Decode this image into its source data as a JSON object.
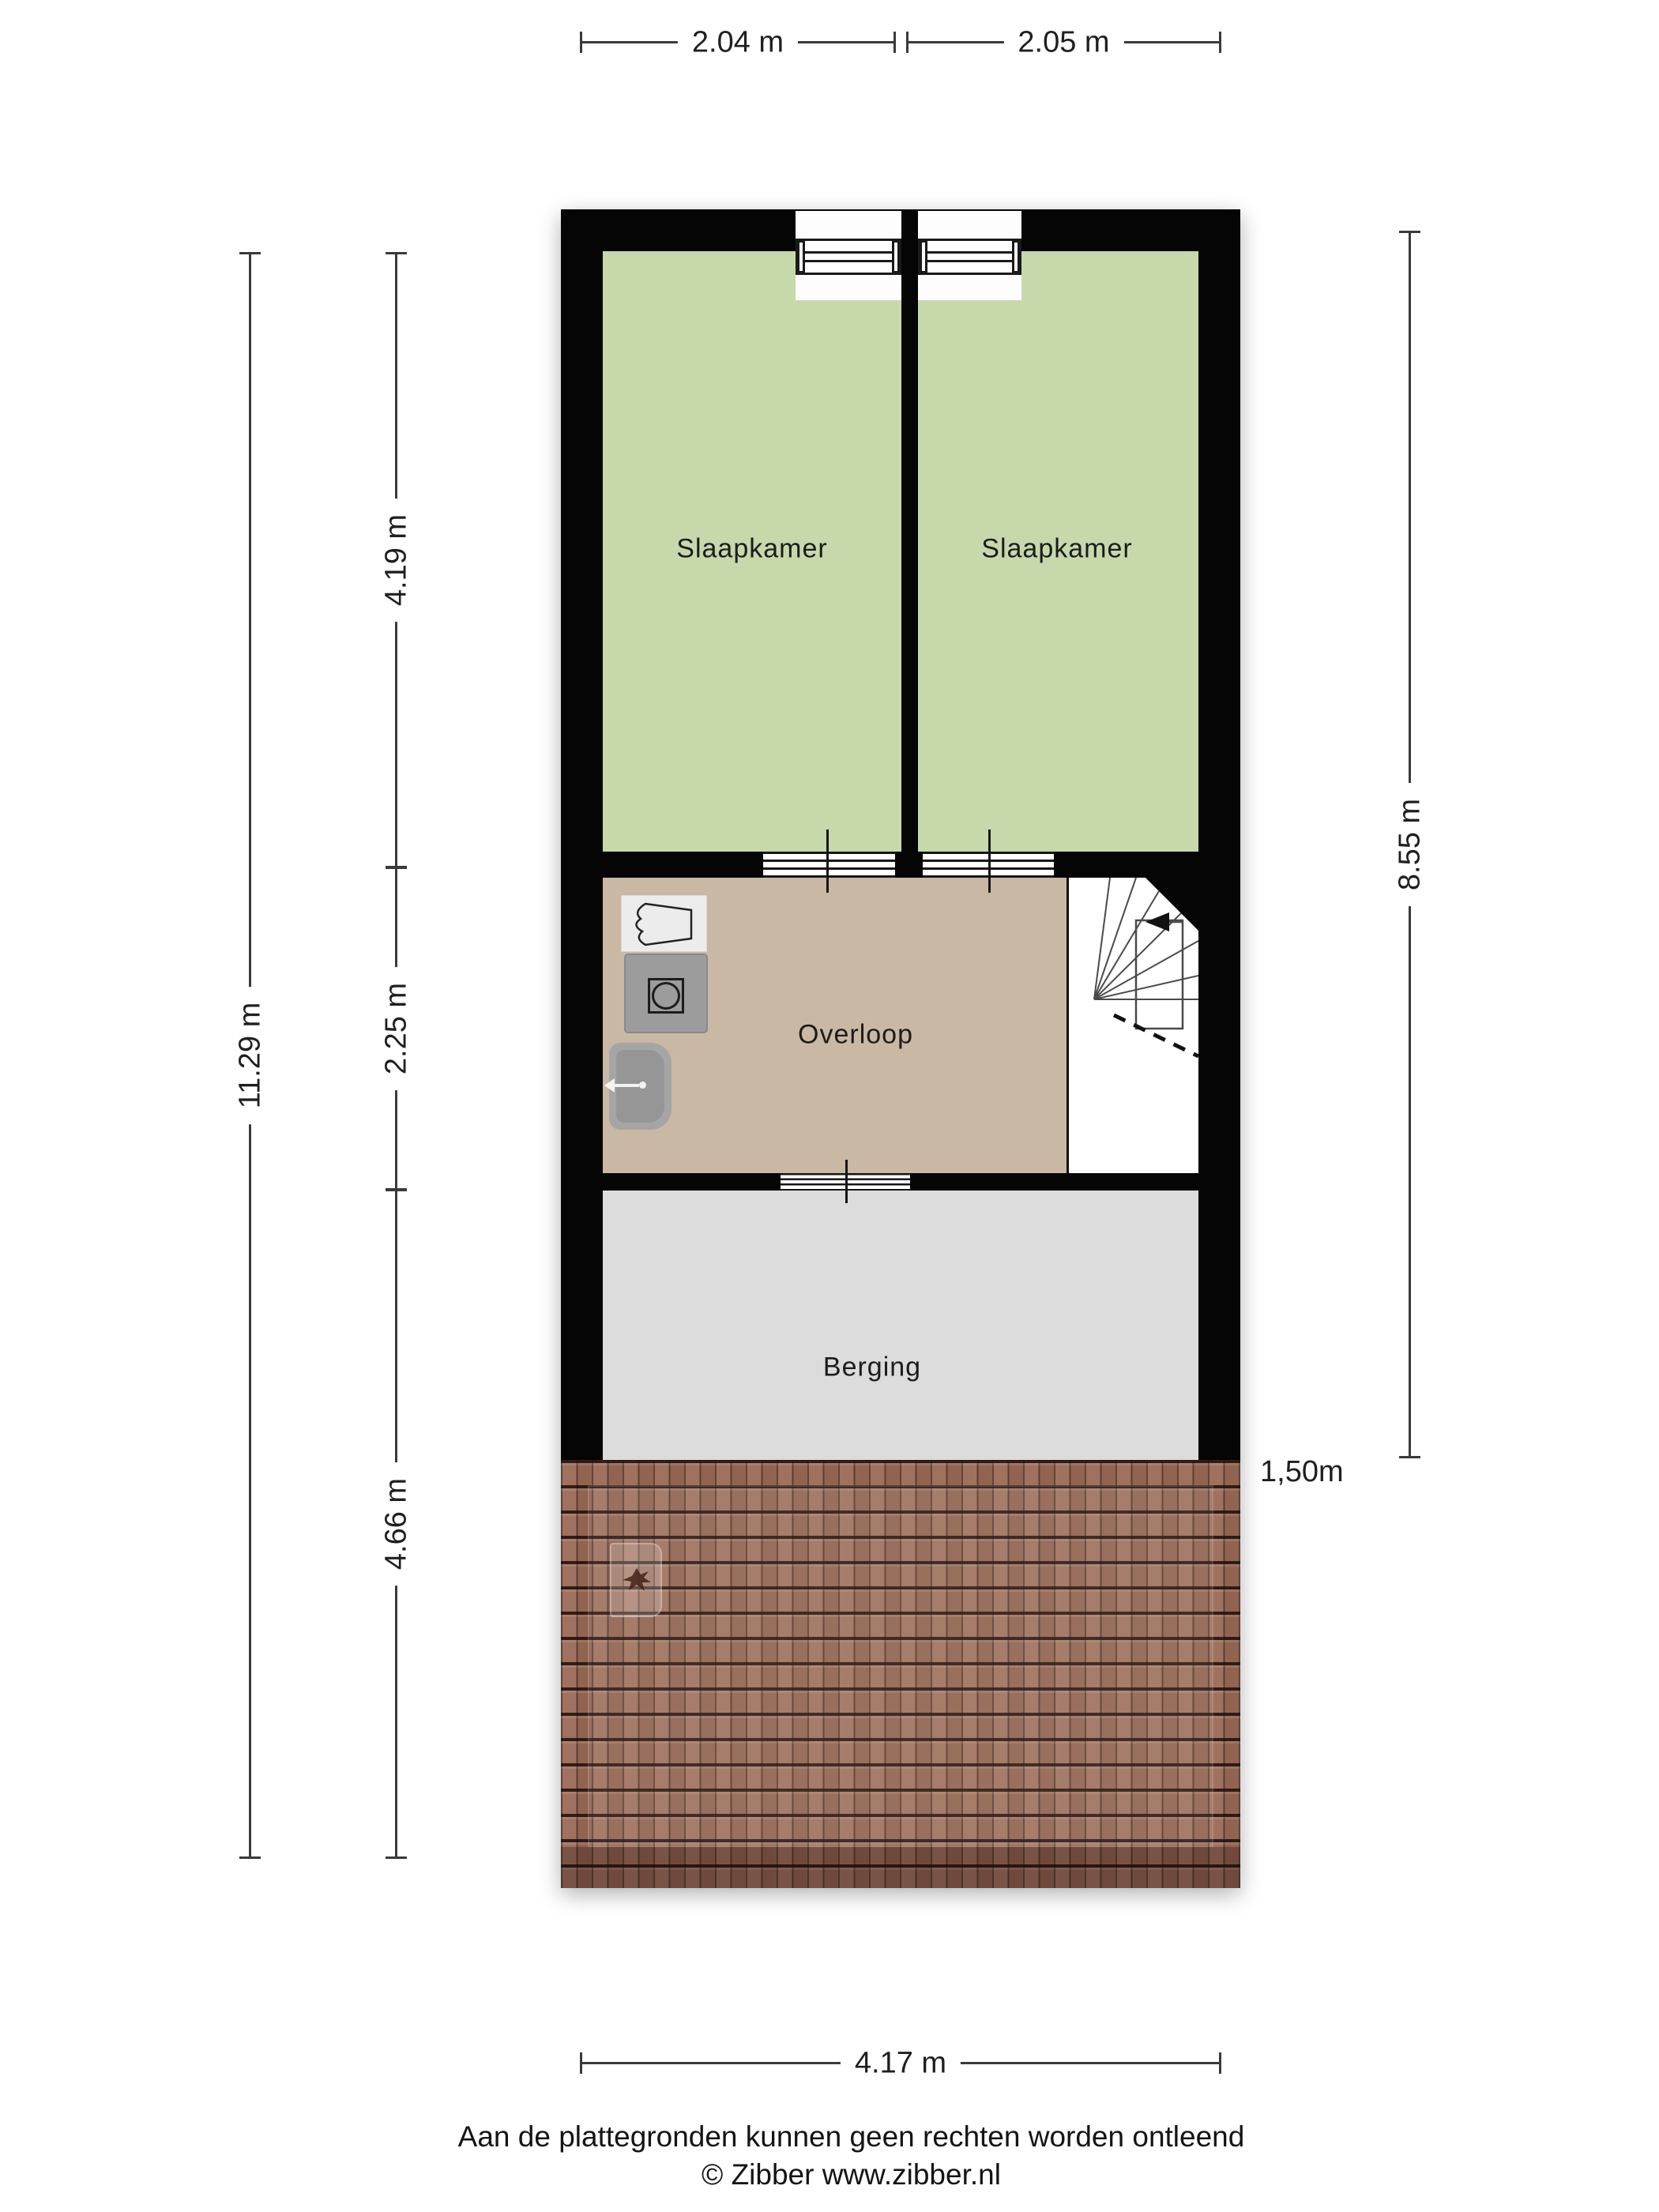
{
  "plan": {
    "rooms": [
      {
        "id": "bedroom-left",
        "label": "Slaapkamer"
      },
      {
        "id": "bedroom-right",
        "label": "Slaapkamer"
      },
      {
        "id": "landing",
        "label": "Overloop"
      },
      {
        "id": "storage",
        "label": "Berging"
      }
    ],
    "dimensions": {
      "top": [
        {
          "label": "2.04 m"
        },
        {
          "label": "2.05 m"
        }
      ],
      "left_total": {
        "label": "11.29 m"
      },
      "left_segments": [
        {
          "label": "4.19 m"
        },
        {
          "label": "2.25 m"
        },
        {
          "label": "4.66 m"
        }
      ],
      "right": {
        "label": "8.55 m"
      },
      "bottom": {
        "label": "4.17 m"
      },
      "roof_depth": {
        "label": "1,50m"
      }
    },
    "colors": {
      "bedroom_green": "#c7d9ab",
      "landing_tan": "#c9b8a3",
      "storage_gray": "#dcdcdc",
      "roof_brown": "#9a6a57",
      "wall_black": "#050505"
    }
  },
  "footer": {
    "disclaimer": "Aan de plattegronden kunnen geen rechten worden ontleend",
    "copyright": "© Zibber www.zibber.nl"
  }
}
